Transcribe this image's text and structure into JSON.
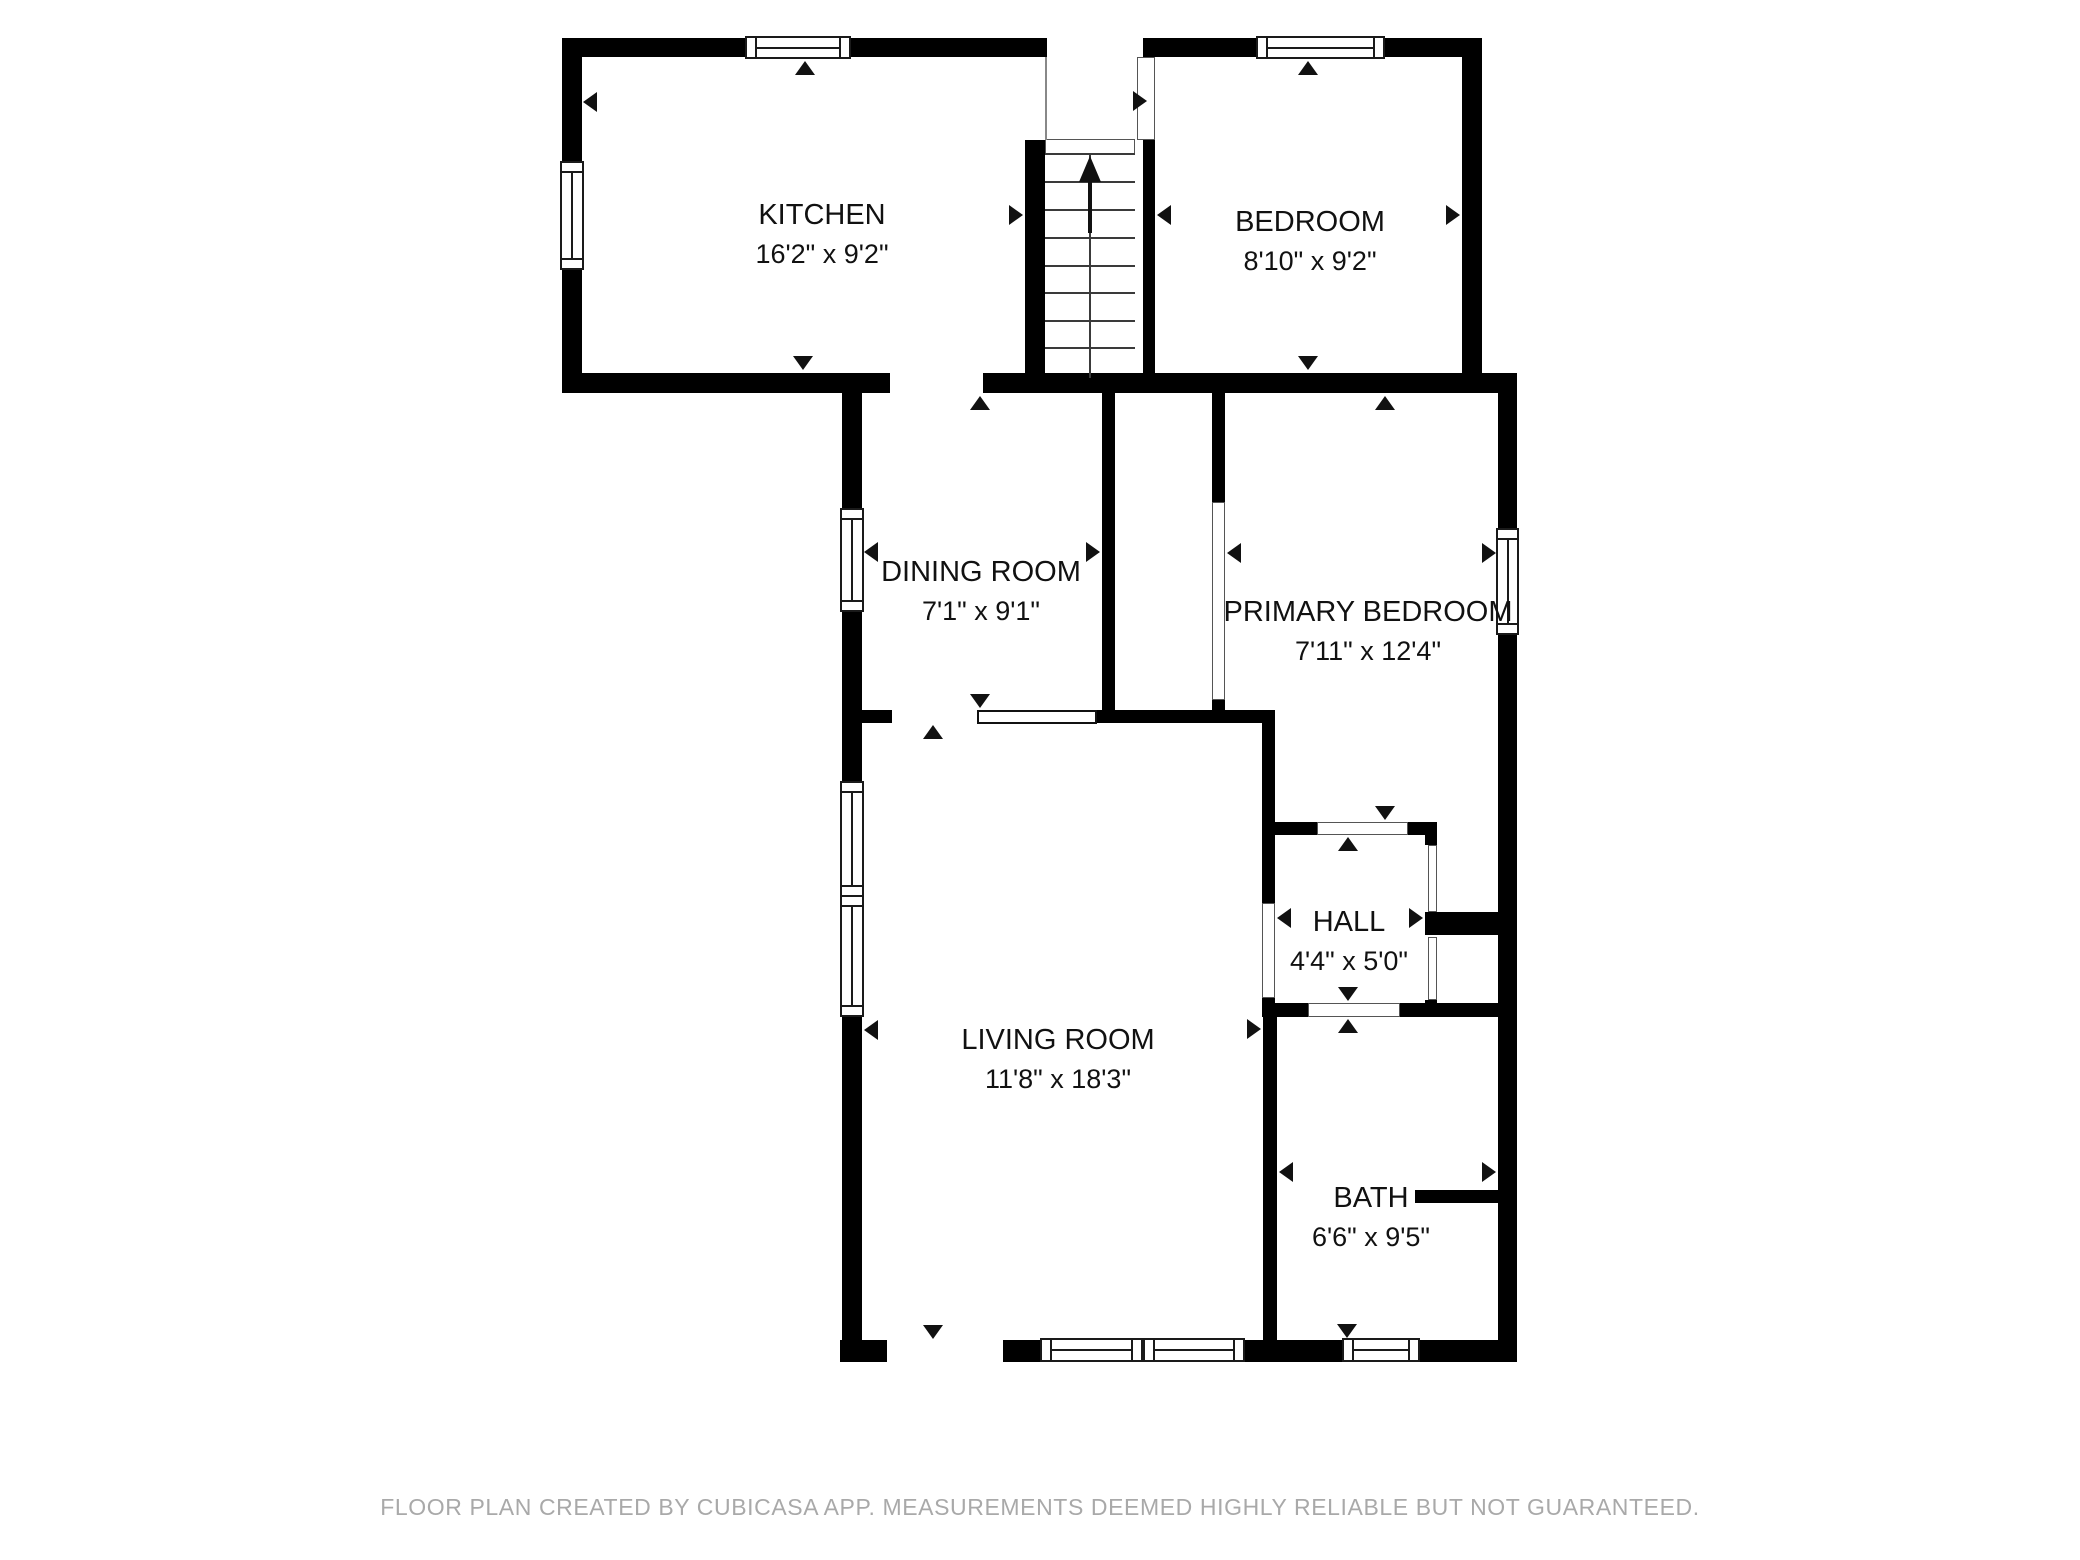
{
  "title": "Floor plan",
  "footer": {
    "text": "FLOOR PLAN CREATED BY CUBICASA APP. MEASUREMENTS DEEMED HIGHLY RELIABLE BUT NOT GUARANTEED."
  },
  "colors": {
    "wall": "#000000",
    "background": "#ffffff",
    "label_text": "#111111",
    "footer_text": "#a9a9a9"
  },
  "rooms": [
    {
      "id": "kitchen",
      "name": "KITCHEN",
      "dims": "16'2\" x 9'2\"",
      "cx": 822,
      "cy": 215
    },
    {
      "id": "bedroom",
      "name": "BEDROOM",
      "dims": "8'10\" x 9'2\"",
      "cx": 1310,
      "cy": 222
    },
    {
      "id": "dining-room",
      "name": "DINING ROOM",
      "dims": "7'1\" x 9'1\"",
      "cx": 981,
      "cy": 572
    },
    {
      "id": "primary-bedroom",
      "name": "PRIMARY BEDROOM",
      "dims": "7'11\" x 12'4\"",
      "cx": 1368,
      "cy": 612
    },
    {
      "id": "hall",
      "name": "HALL",
      "dims": "4'4\" x 5'0\"",
      "cx": 1349,
      "cy": 922
    },
    {
      "id": "living-room",
      "name": "LIVING ROOM",
      "dims": "11'8\" x 18'3\"",
      "cx": 1058,
      "cy": 1040
    },
    {
      "id": "bath",
      "name": "BATH",
      "dims": "6'6\" x 9'5\"",
      "cx": 1371,
      "cy": 1198
    }
  ],
  "geometry": {
    "canvas": {
      "w": 2080,
      "h": 1560
    },
    "walls": [
      [
        562,
        38,
        185,
        19
      ],
      [
        851,
        38,
        196,
        19
      ],
      [
        1143,
        38,
        117,
        19
      ],
      [
        1383,
        38,
        99,
        19
      ],
      [
        562,
        38,
        20,
        125
      ],
      [
        562,
        268,
        20,
        125
      ],
      [
        562,
        373,
        328,
        20
      ],
      [
        983,
        373,
        534,
        20
      ],
      [
        1462,
        38,
        20,
        340
      ],
      [
        1025,
        140,
        20,
        238
      ],
      [
        1143,
        140,
        12,
        238
      ],
      [
        842,
        393,
        20,
        117
      ],
      [
        842,
        610,
        20,
        102
      ],
      [
        1102,
        393,
        13,
        319
      ],
      [
        1212,
        393,
        13,
        109
      ],
      [
        1212,
        700,
        13,
        12
      ],
      [
        842,
        710,
        50,
        13
      ],
      [
        1097,
        710,
        178,
        13
      ],
      [
        1262,
        723,
        13,
        180
      ],
      [
        1262,
        998,
        13,
        19
      ],
      [
        1275,
        822,
        42,
        13
      ],
      [
        1408,
        822,
        29,
        13
      ],
      [
        1425,
        833,
        12,
        12
      ],
      [
        1425,
        912,
        73,
        23
      ],
      [
        1425,
        1000,
        12,
        17
      ],
      [
        1498,
        373,
        19,
        157
      ],
      [
        1498,
        633,
        19,
        729
      ],
      [
        1262,
        1003,
        46,
        14
      ],
      [
        1400,
        1003,
        98,
        14
      ],
      [
        1263,
        1017,
        14,
        326
      ],
      [
        1415,
        1190,
        83,
        13
      ],
      [
        842,
        723,
        20,
        60
      ],
      [
        842,
        1015,
        20,
        347
      ],
      [
        840,
        1340,
        47,
        22
      ],
      [
        1003,
        1340,
        37,
        22
      ],
      [
        1245,
        1340,
        97,
        22
      ],
      [
        1420,
        1340,
        97,
        22
      ]
    ],
    "windows": [
      {
        "x": 745,
        "y": 36,
        "w": 106,
        "h": 23,
        "o": "h",
        "name": "kitchen-top-window"
      },
      {
        "x": 560,
        "y": 161,
        "w": 24,
        "h": 109,
        "o": "v",
        "name": "kitchen-left-window"
      },
      {
        "x": 1256,
        "y": 36,
        "w": 129,
        "h": 23,
        "o": "h",
        "name": "bedroom-top-window"
      },
      {
        "x": 840,
        "y": 508,
        "w": 24,
        "h": 104,
        "o": "v",
        "name": "dining-room-window"
      },
      {
        "x": 1496,
        "y": 528,
        "w": 23,
        "h": 107,
        "o": "v",
        "name": "primary-bedroom-window"
      },
      {
        "x": 840,
        "y": 781,
        "w": 24,
        "h": 116,
        "o": "v",
        "name": "living-room-left-window-1"
      },
      {
        "x": 840,
        "y": 895,
        "w": 24,
        "h": 122,
        "o": "v",
        "name": "living-room-left-window-2"
      },
      {
        "x": 1040,
        "y": 1338,
        "w": 103,
        "h": 24,
        "o": "h",
        "name": "living-room-bottom-window-1"
      },
      {
        "x": 1143,
        "y": 1338,
        "w": 102,
        "h": 24,
        "o": "h",
        "name": "living-room-bottom-window-2"
      },
      {
        "x": 1342,
        "y": 1338,
        "w": 78,
        "h": 24,
        "o": "h",
        "name": "bath-window"
      }
    ],
    "openings": [
      {
        "x": 1045,
        "y": 139,
        "w": 90,
        "h": 15,
        "t": "thin",
        "name": "entry-door-opening"
      },
      {
        "x": 1137,
        "y": 57,
        "w": 18,
        "h": 83,
        "t": "thin",
        "name": "bedroom-door-opening"
      },
      {
        "x": 1212,
        "y": 502,
        "w": 13,
        "h": 198,
        "t": "thin",
        "name": "primary-closet-opening"
      },
      {
        "x": 1262,
        "y": 903,
        "w": 13,
        "h": 95,
        "t": "thin",
        "name": "hall-west-door-opening"
      },
      {
        "x": 1317,
        "y": 822,
        "w": 91,
        "h": 13,
        "t": "thin",
        "name": "hall-north-door-opening"
      },
      {
        "x": 1308,
        "y": 1003,
        "w": 92,
        "h": 14,
        "t": "thin",
        "name": "hall-south-door-opening"
      },
      {
        "x": 1428,
        "y": 845,
        "w": 9,
        "h": 67,
        "t": "thin",
        "name": "closet-1-front"
      },
      {
        "x": 1428,
        "y": 937,
        "w": 9,
        "h": 63,
        "t": "thin",
        "name": "closet-2-front"
      },
      {
        "x": 977,
        "y": 710,
        "w": 120,
        "h": 14,
        "t": "leaf",
        "name": "dining-door-leaf"
      }
    ],
    "lines": [
      [
        1045,
        57,
        2,
        83
      ]
    ],
    "arrows": [
      {
        "d": "left",
        "x": 583,
        "y": 102
      },
      {
        "d": "up",
        "x": 805,
        "y": 61
      },
      {
        "d": "right",
        "x": 1023,
        "y": 215
      },
      {
        "d": "down",
        "x": 803,
        "y": 370
      },
      {
        "d": "left",
        "x": 1157,
        "y": 215
      },
      {
        "d": "up",
        "x": 1308,
        "y": 61
      },
      {
        "d": "right",
        "x": 1460,
        "y": 215
      },
      {
        "d": "down",
        "x": 1308,
        "y": 370
      },
      {
        "d": "right",
        "x": 1147,
        "y": 101
      },
      {
        "d": "left",
        "x": 864,
        "y": 552
      },
      {
        "d": "up",
        "x": 980,
        "y": 396
      },
      {
        "d": "right",
        "x": 1100,
        "y": 552
      },
      {
        "d": "down",
        "x": 980,
        "y": 708
      },
      {
        "d": "left",
        "x": 1227,
        "y": 553
      },
      {
        "d": "up",
        "x": 1385,
        "y": 396
      },
      {
        "d": "right",
        "x": 1496,
        "y": 553
      },
      {
        "d": "down",
        "x": 1385,
        "y": 820
      },
      {
        "d": "left",
        "x": 1277,
        "y": 918
      },
      {
        "d": "up",
        "x": 1348,
        "y": 837
      },
      {
        "d": "right",
        "x": 1423,
        "y": 918
      },
      {
        "d": "down",
        "x": 1348,
        "y": 1001
      },
      {
        "d": "left",
        "x": 864,
        "y": 1030
      },
      {
        "d": "up",
        "x": 933,
        "y": 725
      },
      {
        "d": "right",
        "x": 1261,
        "y": 1029
      },
      {
        "d": "down",
        "x": 933,
        "y": 1339
      },
      {
        "d": "left",
        "x": 1279,
        "y": 1172
      },
      {
        "d": "up",
        "x": 1348,
        "y": 1019
      },
      {
        "d": "right",
        "x": 1496,
        "y": 1172
      },
      {
        "d": "down",
        "x": 1347,
        "y": 1338
      }
    ],
    "stairs": {
      "x": 1045,
      "y": 153,
      "w": 90,
      "h": 225,
      "treads": [
        0,
        28,
        56,
        84,
        112,
        139,
        167,
        194
      ]
    }
  }
}
